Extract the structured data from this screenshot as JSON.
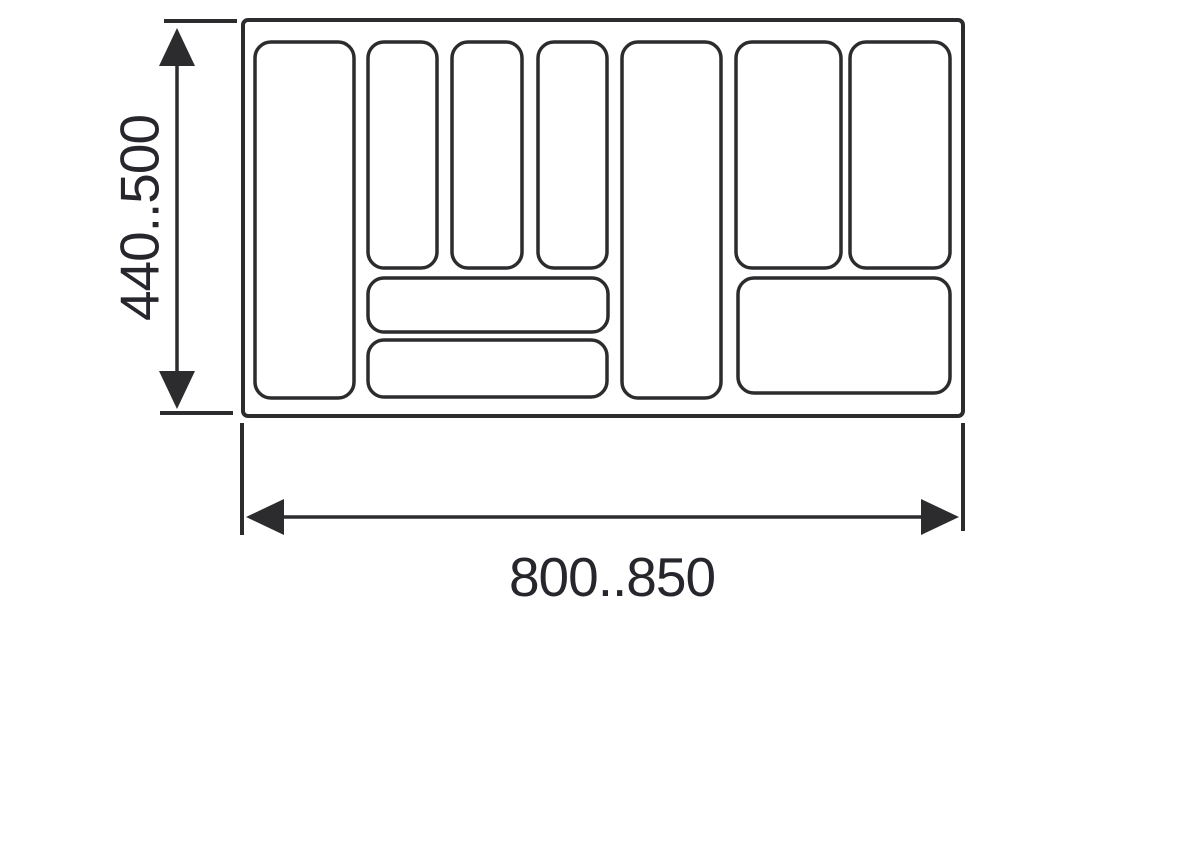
{
  "diagram": {
    "name": "cutlery-tray-insert-dimension-drawing",
    "background": "#ffffff",
    "line_color": "#2c2c2e",
    "text_color": "#26262c",
    "height_dimension": {
      "label": "440..500"
    },
    "width_dimension": {
      "label": "800..850"
    },
    "tray": {
      "x": 243,
      "y": 20,
      "width": 720,
      "height": 396,
      "radius": 5
    },
    "compartment_radius": 16,
    "compartments": [
      {
        "id": "left-tall",
        "x": 255,
        "y": 42,
        "width": 99,
        "height": 356
      },
      {
        "id": "top-slot-1",
        "x": 368,
        "y": 42,
        "width": 69,
        "height": 226
      },
      {
        "id": "top-slot-2",
        "x": 452,
        "y": 42,
        "width": 70,
        "height": 226
      },
      {
        "id": "top-slot-3",
        "x": 538,
        "y": 42,
        "width": 69,
        "height": 226
      },
      {
        "id": "shallow-wide-1",
        "x": 368,
        "y": 278,
        "width": 240,
        "height": 54
      },
      {
        "id": "shallow-wide-2",
        "x": 368,
        "y": 340,
        "width": 239,
        "height": 57
      },
      {
        "id": "center-tall",
        "x": 622,
        "y": 42,
        "width": 99,
        "height": 356
      },
      {
        "id": "right-slot-1",
        "x": 736,
        "y": 42,
        "width": 105,
        "height": 226
      },
      {
        "id": "right-slot-2",
        "x": 850,
        "y": 42,
        "width": 100,
        "height": 226
      },
      {
        "id": "right-wide",
        "x": 738,
        "y": 278,
        "width": 212,
        "height": 115
      }
    ]
  }
}
